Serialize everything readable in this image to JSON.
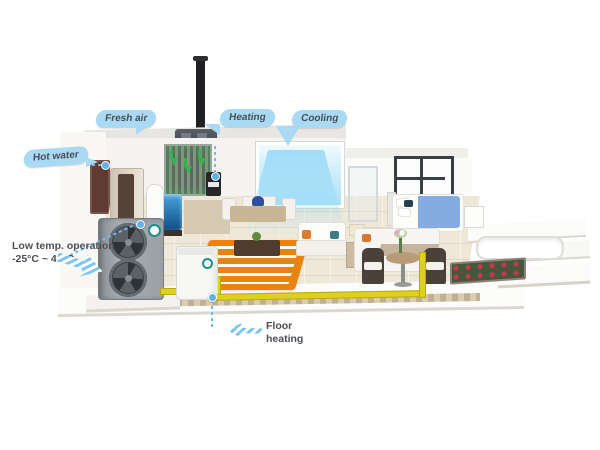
{
  "callouts": {
    "fresh_air": {
      "label": "Fresh air"
    },
    "heating": {
      "label": "Heating"
    },
    "cooling": {
      "label": "Cooling"
    },
    "hot_water": {
      "label": "Hot water"
    },
    "low_temp": {
      "line1": "Low temp. operation",
      "line2": "-25°C ~ 43°C"
    },
    "floor_heating": {
      "label": "Floor heating"
    }
  },
  "colors": {
    "callout_bg": "#a9d9f3",
    "callout_text": "#4a4f55",
    "fresh_air_green": "#35b24f",
    "cool_air_blue": "#8cd4f6",
    "floor_heating_orange": "#e8830f",
    "pipe_yellow": "#ded01e",
    "outdoor_unit_gray": "#9aa0a6",
    "line_blue": "#6cbcec"
  }
}
